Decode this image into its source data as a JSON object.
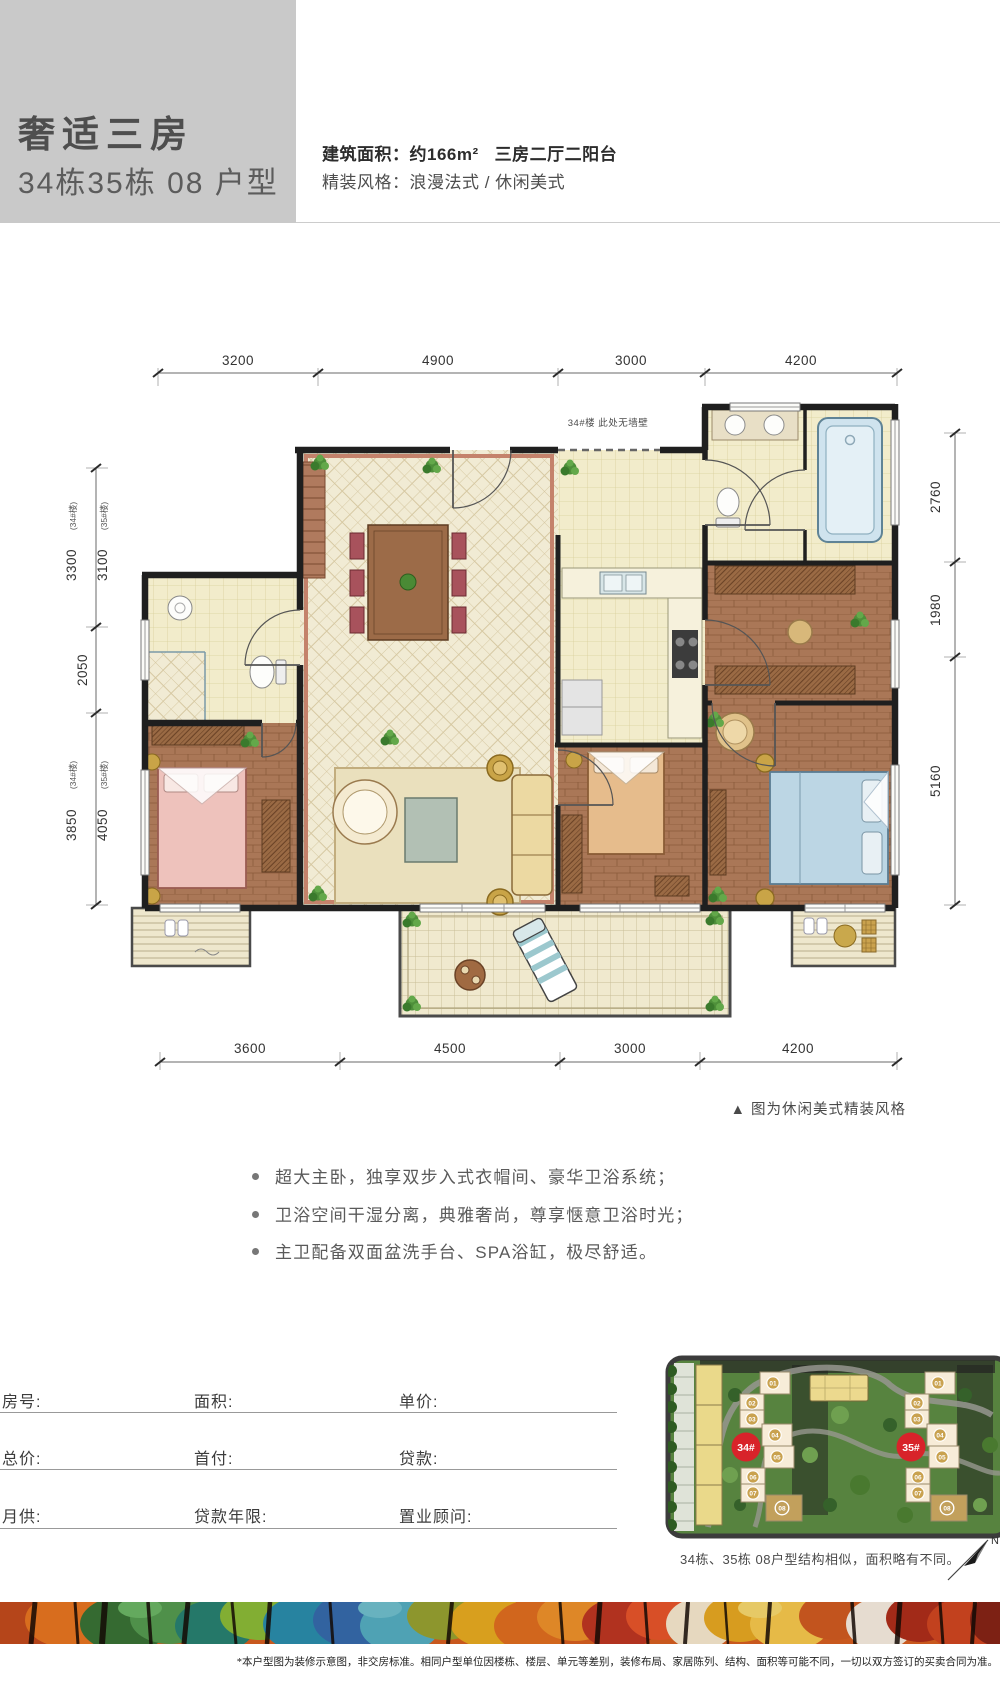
{
  "header": {
    "title": "奢适三房",
    "subtitle": "34栋35栋 08 户型",
    "area_label": "建筑面积：约166m²",
    "rooms_label": "三房二厅二阳台",
    "style_label": "精装风格：浪漫法式 / 休闲美式"
  },
  "floorplan": {
    "note_no_wall": "34#楼 此处无墙壁",
    "caption": "▲ 图为休闲美式精装风格",
    "dims_top": [
      "3200",
      "4900",
      "3000",
      "4200"
    ],
    "dims_bottom": [
      "3600",
      "4500",
      "3000",
      "4200"
    ],
    "dims_left": [
      {
        "value": "3300",
        "building": "(34#楼)"
      },
      {
        "value": "3100",
        "building": "(35#楼)"
      },
      {
        "value": "2050",
        "building": ""
      },
      {
        "value": "3850",
        "building": "(34#楼)"
      },
      {
        "value": "4050",
        "building": "(35#楼)"
      }
    ],
    "dims_right": [
      "2760",
      "1980",
      "5160"
    ]
  },
  "features": [
    "超大主卧，独享双步入式衣帽间、豪华卫浴系统；",
    "卫浴空间干湿分离，典雅奢尚，尊享惬意卫浴时光；",
    "主卫配备双面盆洗手台、SPA浴缸，极尽舒适。"
  ],
  "form": {
    "rows": [
      {
        "c1": "房号:",
        "c2": "面积:",
        "c3": "单价:"
      },
      {
        "c1": "总价:",
        "c2": "首付:",
        "c3": "贷款:"
      },
      {
        "c1": "月供:",
        "c2": "贷款年限:",
        "c3": "置业顾问:"
      }
    ]
  },
  "sitemap": {
    "label_34": "34#",
    "label_35": "35#",
    "units": [
      "01",
      "02",
      "03",
      "04",
      "05",
      "06",
      "07",
      "08"
    ],
    "caption": "34栋、35栋 08户型结构相似，面积略有不同。",
    "compass": "N"
  },
  "footer": {
    "disclaimer": "*本户型图为装修示意图，非交房标准。相同户型单位因楼栋、楼层、单元等差别，装修布局、家居陈列、结构、面积等可能不同，一切以双方签订的买卖合同为准。"
  },
  "colors": {
    "header_gray": "#c9c9c9",
    "accent_red": "#d8232a",
    "wall": "#1f1f1f",
    "wood": "#aa7757",
    "tile_cream": "#f1ebd4"
  }
}
